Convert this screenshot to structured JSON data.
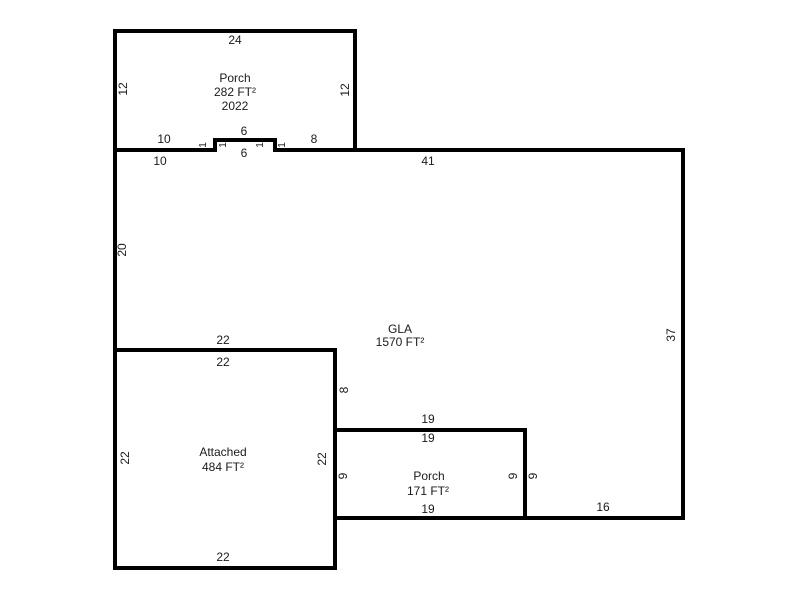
{
  "sketch": {
    "background_color": "#ffffff",
    "wall_color": "#000000",
    "text_color": "#1a1a1a",
    "rooms": {
      "porch_top": {
        "title": "Porch",
        "area": "282 FT²",
        "year": "2022"
      },
      "gla": {
        "title": "GLA",
        "area": "1570 FT²"
      },
      "attached": {
        "title": "Attached",
        "area": "484 FT²"
      },
      "porch_bottom": {
        "title": "Porch",
        "area": "171 FT²"
      }
    },
    "dims": {
      "porch_top": {
        "width_top": "24",
        "height_left": "12",
        "height_right": "12",
        "bottom_left_seg": "10",
        "notch_top": "6",
        "bottom_right_seg": "8",
        "step_left_outer": "1",
        "step_left_inner": "1",
        "step_right_inner": "1",
        "step_right_outer": "1"
      },
      "gla": {
        "top_left_seg": "10",
        "notch_bottom": "6",
        "top_right_seg": "41",
        "left_height": "20",
        "right_height": "37",
        "attached_top_width": "22",
        "notch_step_height": "8",
        "porch_top_width": "19",
        "porch_right_height": "9",
        "bottom_right_seg": "16"
      },
      "attached": {
        "width_top": "22",
        "height_left": "22",
        "height_right": "22",
        "width_bottom": "22"
      },
      "porch_bottom": {
        "width_top": "19",
        "height_left": "9",
        "height_right": "9",
        "width_bottom": "19"
      }
    }
  }
}
